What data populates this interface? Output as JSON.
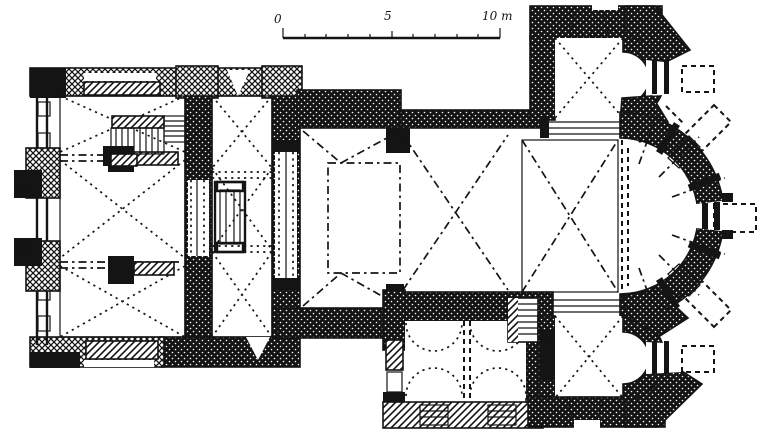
{
  "scale_bar": {
    "start_label": "0",
    "mid_label": "5",
    "end_label": "10 m"
  },
  "colors": {
    "ink": "#141414",
    "paper": "#ffffff"
  }
}
